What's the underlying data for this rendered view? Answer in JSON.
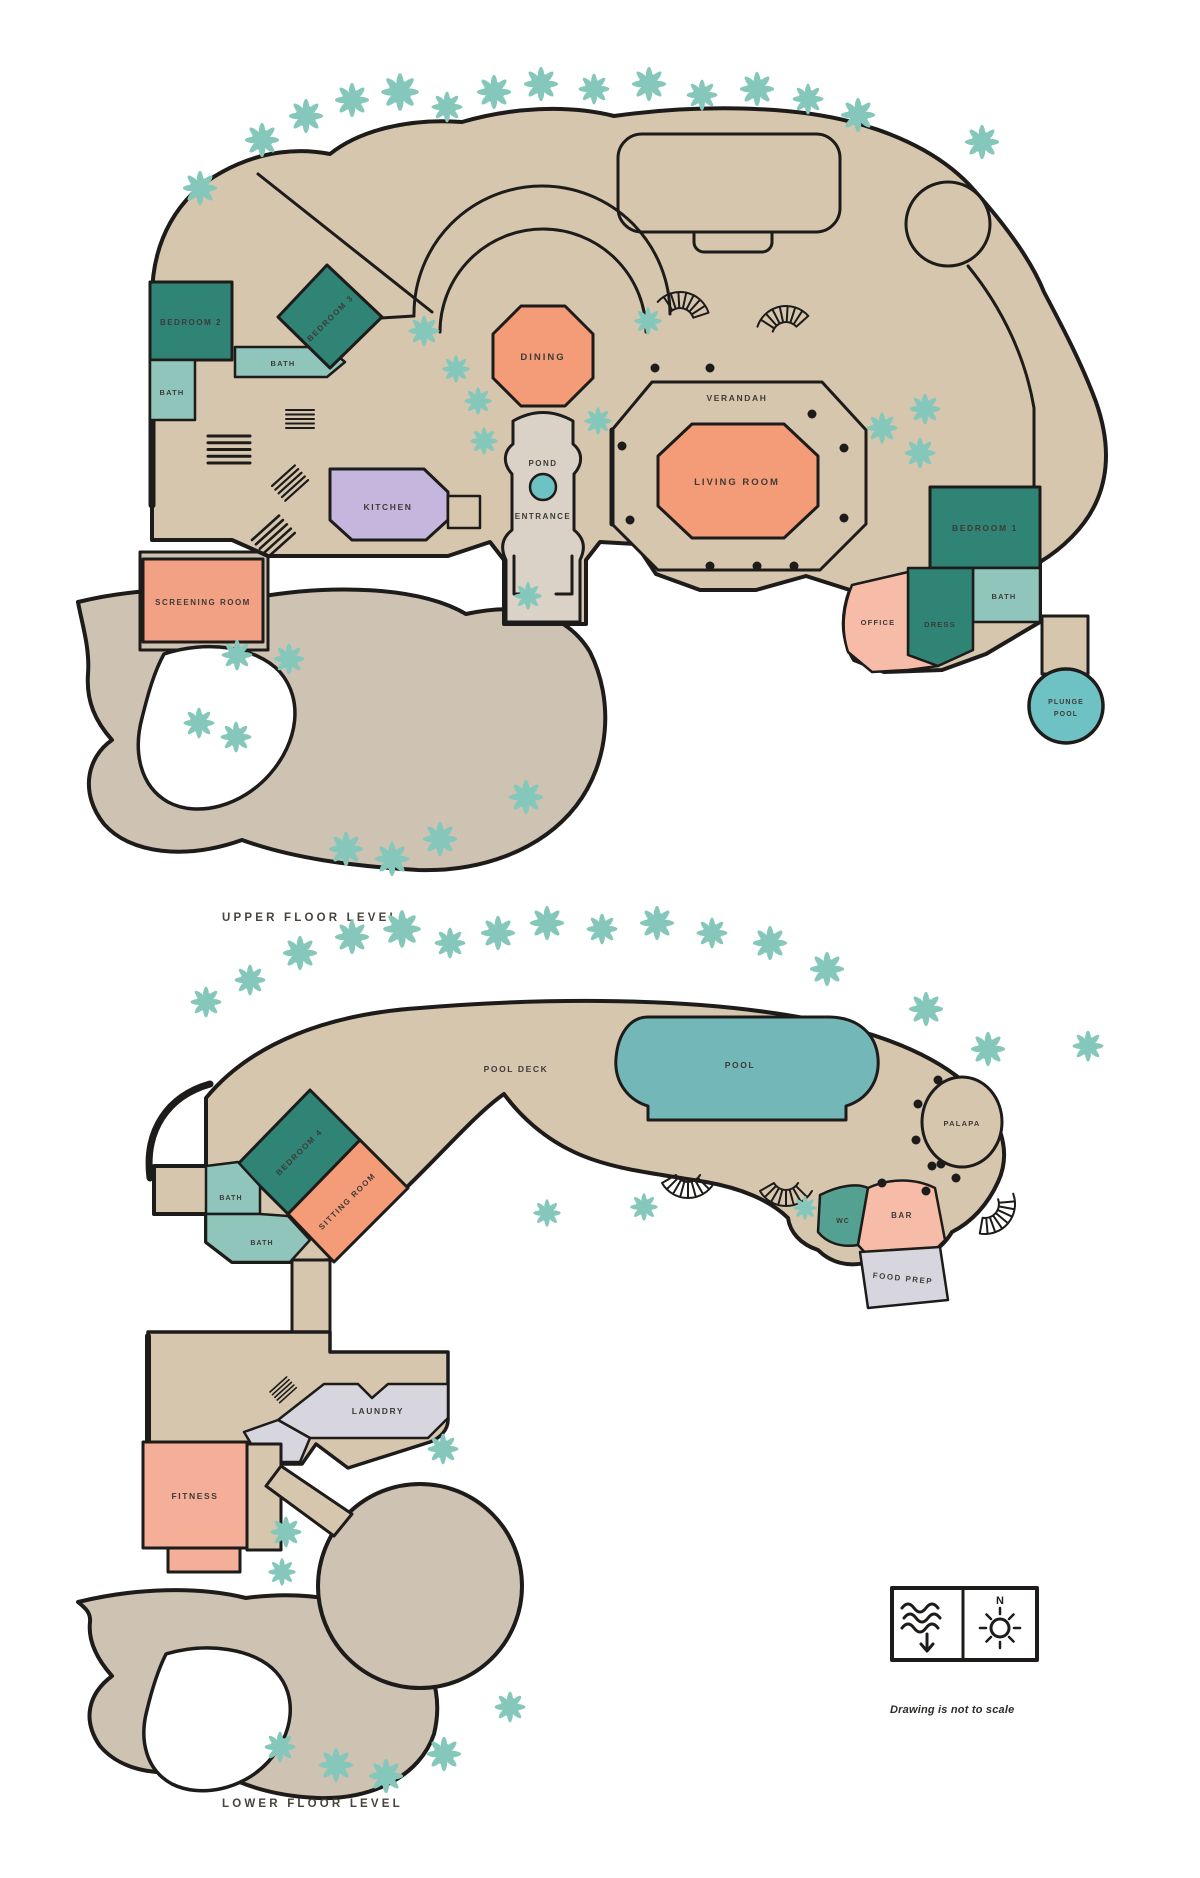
{
  "palette": {
    "floor_tan": "#D6C6AE",
    "drive_tan": "#CEC2B2",
    "entry_gray": "#DAD2C6",
    "bedroom_teal": "#2F8476",
    "bath_teal": "#90C5BB",
    "wc_teal": "#55A191",
    "living_orange": "#F49B77",
    "office_pink": "#F7BCA7",
    "screening_coral": "#F2A185",
    "fitness_pink": "#F5AE97",
    "kitchen_lavender": "#C5B6DE",
    "pool_teal": "#73B7B8",
    "plunge_teal": "#6FC2C3",
    "utility_gray": "#D7D5DD",
    "palm_green": "#85C8BB",
    "outline_ink": "#1D1C1A",
    "label_ink": "#3E3B38"
  },
  "upper_floor": {
    "title": "UPPER FLOOR LEVEL",
    "rooms": {
      "bedroom2": {
        "label": "BEDROOM 2"
      },
      "bath_main": {
        "label": "BATH"
      },
      "bath_hall": {
        "label": "BATH"
      },
      "bedroom3": {
        "label": "BEDROOM 3"
      },
      "kitchen": {
        "label": "KITCHEN"
      },
      "dining": {
        "label": "DINING"
      },
      "pond": {
        "label": "POND"
      },
      "entrance": {
        "label": "ENTRANCE"
      },
      "verandah": {
        "label": "VERANDAH"
      },
      "living_room": {
        "label": "LIVING ROOM"
      },
      "bedroom1": {
        "label": "BEDROOM 1"
      },
      "bath1": {
        "label": "BATH"
      },
      "dress": {
        "label": "DRESS"
      },
      "office": {
        "label": "OFFICE"
      },
      "plunge_pool": {
        "line1": "PLUNGE",
        "line2": "POOL"
      },
      "screening_room": {
        "label": "SCREENING ROOM"
      }
    }
  },
  "lower_floor": {
    "title": "LOWER FLOOR LEVEL",
    "rooms": {
      "pool_deck": {
        "label": "POOL DECK"
      },
      "pool": {
        "label": "POOL"
      },
      "palapa": {
        "label": "PALAPA"
      },
      "bedroom4": {
        "label": "BEDROOM 4"
      },
      "sitting_room": {
        "label": "SITTING ROOM"
      },
      "bath_a": {
        "label": "BATH"
      },
      "bath_b": {
        "label": "BATH"
      },
      "wc": {
        "label": "WC"
      },
      "bar": {
        "label": "BAR"
      },
      "food_prep": {
        "label": "FOOD PREP"
      },
      "laundry": {
        "label": "LAUNDRY"
      },
      "fitness": {
        "label": "FITNESS"
      }
    }
  },
  "legend": {
    "compass_north": "N",
    "note": "Drawing is not to scale"
  }
}
